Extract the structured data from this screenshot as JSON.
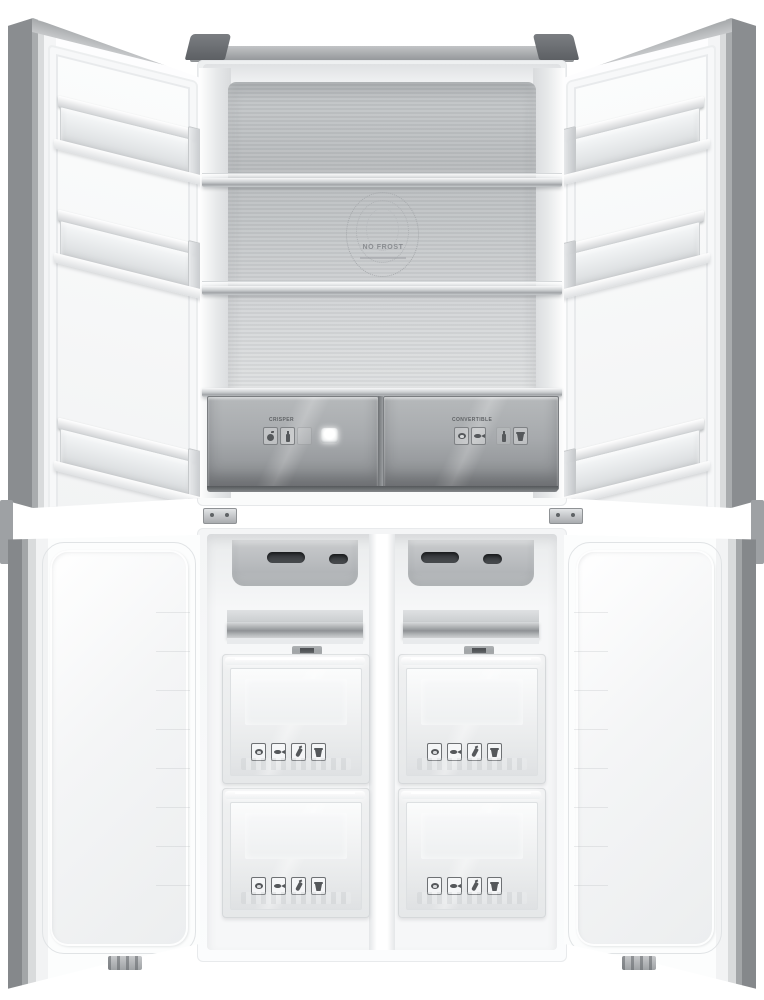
{
  "scene": {
    "description": "Grayscale product photo of a four-door cross-door refrigerator shown front-on with all four doors open",
    "upper_compartment": "refrigerator",
    "lower_compartment": "freezer"
  },
  "colors": {
    "background": "#ffffff",
    "cabinet_gray": "#8f9295",
    "hinge_dark": "#55585c",
    "steel_back_panel": "#c2c5c7",
    "glass_drawer_gray": "#9a9da0",
    "liner_white": "#fbfcfd",
    "vent_slot_dark": "#3c3f42"
  },
  "fridge": {
    "logo": {
      "title": "NO FROST"
    },
    "shelves_count": 3,
    "door_bins_per_door": 3,
    "drawers": {
      "left": {
        "label": "CRISPER",
        "icons": [
          "fruit-icon",
          "bottle-icon"
        ],
        "button": "white-round-button"
      },
      "right": {
        "label": "CONVERTIBLE",
        "icons": [
          "meat-icon",
          "fish-icon",
          "bottle-icon",
          "dessert-icon"
        ]
      }
    }
  },
  "freezer": {
    "columns": 2,
    "drawers_per_column": 2,
    "vent_slots_per_column": 2,
    "drawer_icons": [
      "meat-icon",
      "fish-icon",
      "pepper-icon",
      "dessert-icon"
    ]
  }
}
